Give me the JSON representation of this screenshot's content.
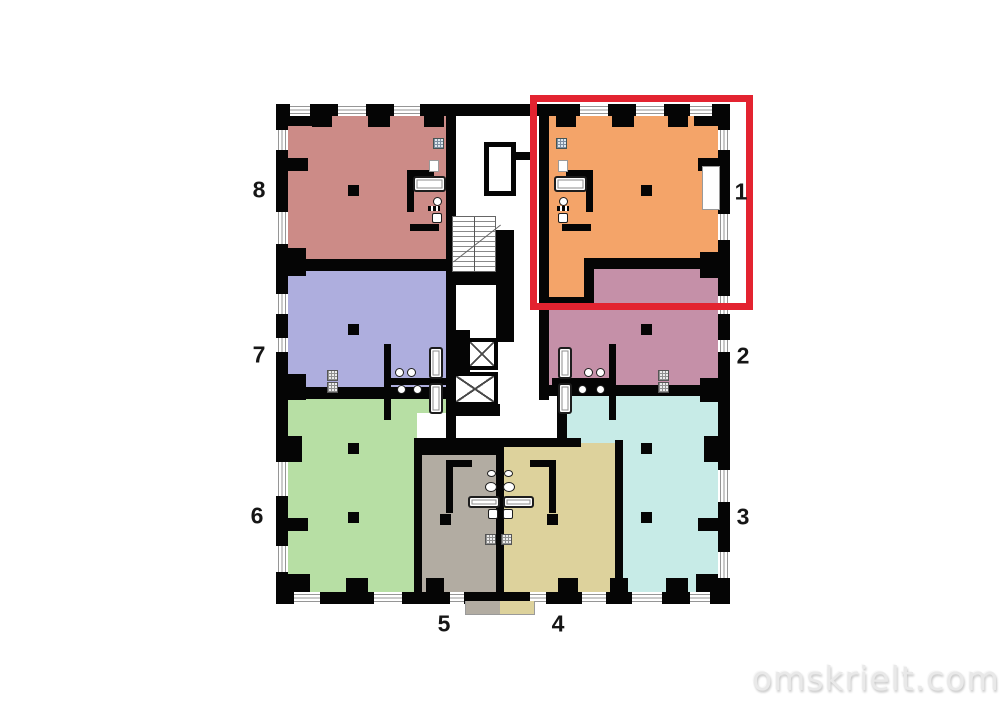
{
  "watermark": {
    "text": "omskrielt.com"
  },
  "floorplan": {
    "highlight": {
      "unit": "1",
      "frame_color": "#e32330"
    },
    "units": [
      {
        "number": "1",
        "color": "#f4a469"
      },
      {
        "number": "2",
        "color": "#c590a8"
      },
      {
        "number": "3",
        "color": "#c7ebe7"
      },
      {
        "number": "4",
        "color": "#ddd29c"
      },
      {
        "number": "5",
        "color": "#b2aca2"
      },
      {
        "number": "6",
        "color": "#b7dfa4"
      },
      {
        "number": "7",
        "color": "#aeaede"
      },
      {
        "number": "8",
        "color": "#cc8b87"
      }
    ]
  }
}
